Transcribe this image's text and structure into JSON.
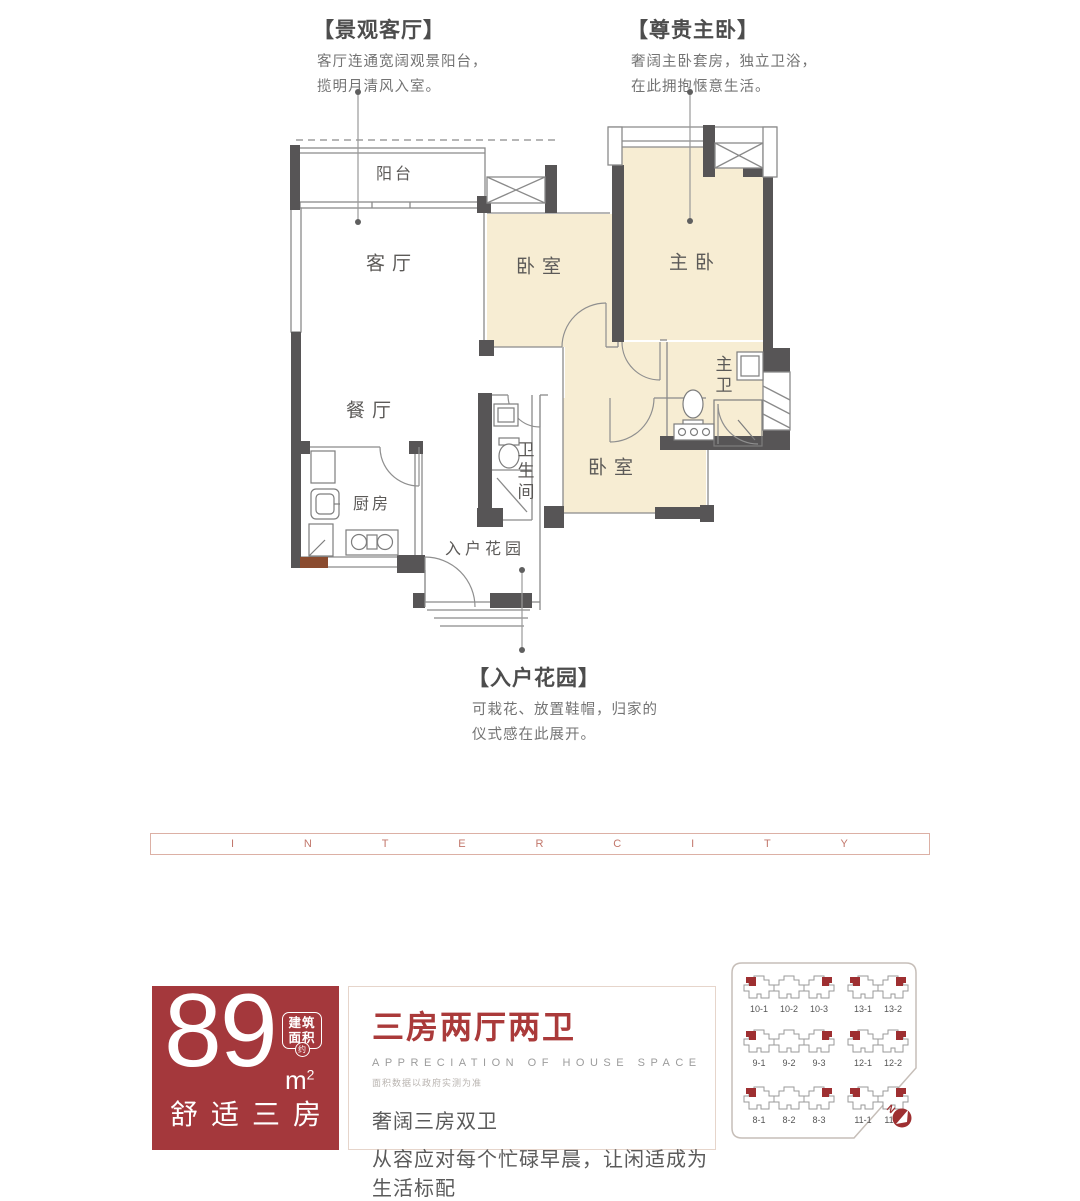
{
  "callouts": {
    "living": {
      "title": "【景观客厅】",
      "line1": "客厅连通宽阔观景阳台，",
      "line2": "揽明月清风入室。"
    },
    "master": {
      "title": "【尊贵主卧】",
      "line1": "奢阔主卧套房，独立卫浴，",
      "line2": "在此拥抱惬意生活。"
    },
    "garden": {
      "title": "【入户花园】",
      "line1": "可栽花、放置鞋帽，归家的",
      "line2": "仪式感在此展开。"
    }
  },
  "floorplan": {
    "rooms": {
      "balcony": "阳台",
      "living": "客厅",
      "dining": "餐厅",
      "kitchen": "厨房",
      "bathroom": "卫生间",
      "bedroom2": "卧室",
      "master_bedroom": "主卧",
      "master_bath": "主卫",
      "bedroom3": "卧室",
      "entry_garden": "入户花园"
    }
  },
  "banner": {
    "letters": [
      "I",
      "N",
      "T",
      "E",
      "R",
      "C",
      "I",
      "T",
      "Y"
    ]
  },
  "area_card": {
    "number": "89",
    "unit": "m",
    "unit_sup": "2",
    "seal_line1": "建筑",
    "seal_line2": "面积",
    "seal_small": "约",
    "subtitle": "舒适三房"
  },
  "info_card": {
    "title": "三房两厅两卫",
    "subtitle_en": "APPRECIATION OF HOUSE SPACE",
    "note": "面积数据以政府实测为准",
    "line1": "奢阔三房双卫",
    "line2": "从容应对每个忙碌早晨，让闲适成为生活标配"
  },
  "site_plan": {
    "rows": [
      [
        "10-1",
        "10-2",
        "10-3",
        "13-1",
        "13-2"
      ],
      [
        "9-1",
        "9-2",
        "9-3",
        "12-1",
        "12-2"
      ],
      [
        "8-1",
        "8-2",
        "8-3",
        "11-1",
        "11-2"
      ]
    ],
    "compass": "N"
  },
  "colors": {
    "room_fill": "#f7edd3",
    "wall": "#575556",
    "accent_red": "#a4383c",
    "title_red": "#aa3a3a",
    "banner_pink": "#c2776b",
    "wood_brown": "#8a4b2f"
  }
}
